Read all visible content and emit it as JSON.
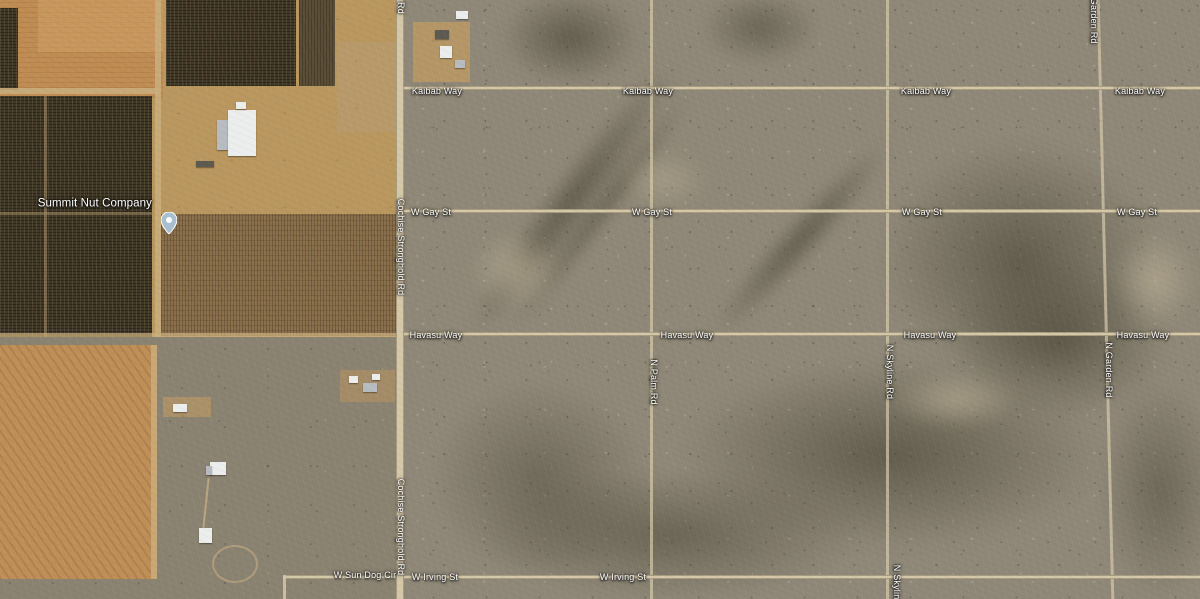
{
  "map": {
    "view": "satellite",
    "place": {
      "name": "Summit Nut Company"
    },
    "roads": {
      "horizontal": [
        "Kaibab Way",
        "W Gay St",
        "Havasu Way",
        "W Irving St",
        "W Sun Dog Cir"
      ],
      "vertical": [
        "Cochise Stronghold Rd",
        "N Palm Rd",
        "N Skyline Rd",
        "N Garden Rd"
      ]
    },
    "marker": {
      "title": "Summit Nut Company",
      "x": 161,
      "y": 212
    },
    "labels": [
      {
        "text": "Kaibab Way",
        "x": 437,
        "y": 92
      },
      {
        "text": "Kaibab Way",
        "x": 648,
        "y": 92
      },
      {
        "text": "Kaibab Way",
        "x": 926,
        "y": 92
      },
      {
        "text": "Kaibab Way",
        "x": 1140,
        "y": 92
      },
      {
        "text": "W Gay St",
        "x": 431,
        "y": 213
      },
      {
        "text": "W Gay St",
        "x": 652,
        "y": 213
      },
      {
        "text": "W Gay St",
        "x": 922,
        "y": 213
      },
      {
        "text": "W Gay St",
        "x": 1137,
        "y": 213
      },
      {
        "text": "Havasu Way",
        "x": 436,
        "y": 336
      },
      {
        "text": "Havasu Way",
        "x": 687,
        "y": 336
      },
      {
        "text": "Havasu Way",
        "x": 930,
        "y": 336
      },
      {
        "text": "Havasu Way",
        "x": 1143,
        "y": 336
      },
      {
        "text": "W Irving St",
        "x": 435,
        "y": 578
      },
      {
        "text": "W Irving St",
        "x": 623,
        "y": 578
      },
      {
        "text": "W Sun Dog Cir",
        "x": 365,
        "y": 576
      },
      {
        "text": "Rd",
        "x": 400,
        "y": 8,
        "vertical": true
      },
      {
        "text": "Cochise Stronghold Rd",
        "x": 400,
        "y": 247,
        "vertical": true
      },
      {
        "text": "Cochise Stronghold Rd",
        "x": 400,
        "y": 527,
        "vertical": true
      },
      {
        "text": "N Palm Rd",
        "x": 653,
        "y": 382,
        "vertical": true
      },
      {
        "text": "N Skyline Rd",
        "x": 889,
        "y": 372,
        "vertical": true
      },
      {
        "text": "N Skyline Rd",
        "x": 896,
        "y": 592,
        "vertical": true
      },
      {
        "text": "N Garden Rd",
        "x": 1093,
        "y": 16,
        "vertical": true
      },
      {
        "text": "N Garden Rd",
        "x": 1108,
        "y": 370,
        "vertical": true
      },
      {
        "text": "Summit Nut Company",
        "x": 152,
        "y": 204,
        "kind": "place",
        "anchor": "right"
      }
    ],
    "colors": {
      "label": "#ffffff",
      "pin": "#a7bfd1",
      "road": "#d5c8a9",
      "desert": "#8f8878",
      "field_orange": "#bf8c53",
      "orchard_dark": "#3e3628"
    }
  }
}
